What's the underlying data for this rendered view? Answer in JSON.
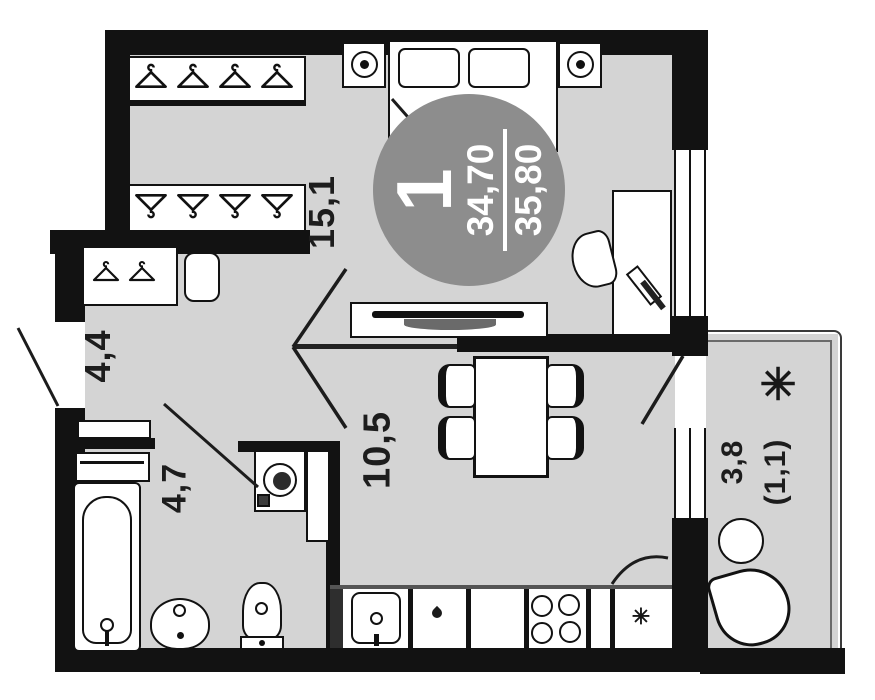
{
  "plan": {
    "unit_badge": {
      "rooms": "1",
      "area_living": "34,70",
      "area_total": "35,80"
    },
    "rooms": {
      "bedroom": {
        "area": "15,1"
      },
      "hallway": {
        "area": "4,4"
      },
      "bathroom": {
        "area": "4,7"
      },
      "kitchen_living": {
        "area": "10,5"
      },
      "balcony": {
        "area": "3,8",
        "area_reduced": "(1,1)"
      }
    },
    "icons": {
      "snowflake_glyph": "✳",
      "flower_glyph": "✳"
    },
    "colors": {
      "floor": "#d4d4d4",
      "wall": "#121212",
      "badge": "#8d8d8d",
      "line": "#1c1c1c"
    }
  }
}
